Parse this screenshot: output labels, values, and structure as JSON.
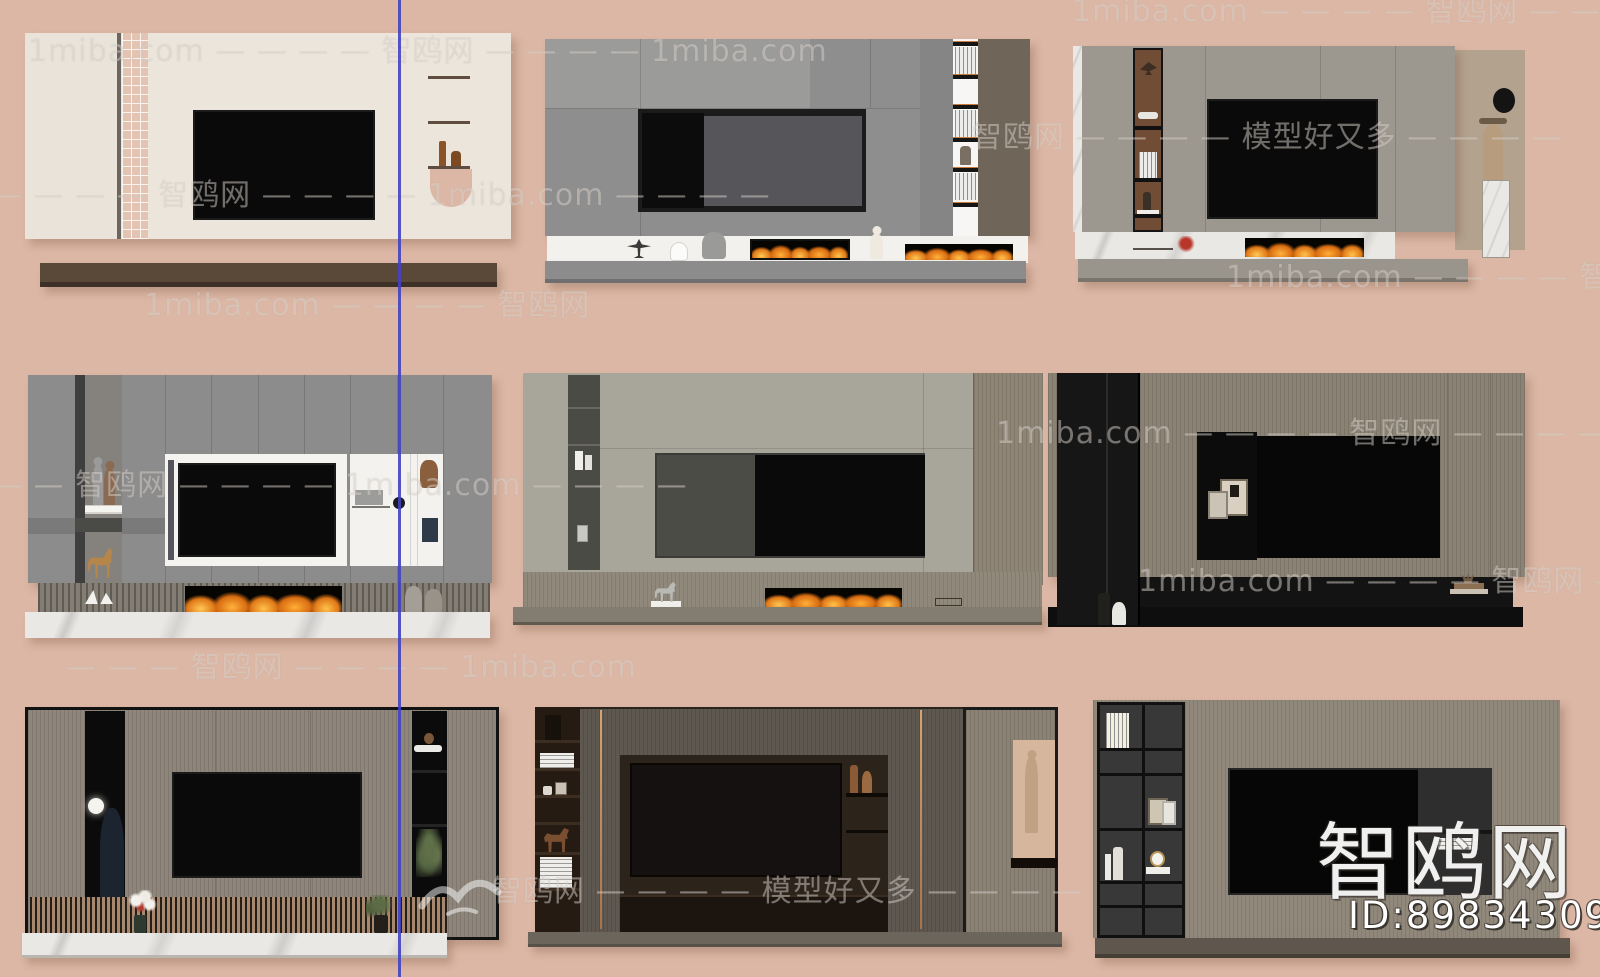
{
  "canvas": {
    "background_color": "#dcb7a5",
    "divider_line_color": "#4343c4",
    "accent_flame_color": "#e07818"
  },
  "watermark": {
    "brand_site": "1miba.com",
    "brand_name": "智鸥网",
    "brand_slogan": "模型好又多",
    "logo": {
      "text": "智鸥网",
      "id": "ID:898343095"
    },
    "rows": [
      {
        "text": "1miba.com — — — — 智鸥网 — — — — —"
      },
      {
        "text": "1miba.com — — — — 智鸥网 — — — — 1miba.com"
      },
      {
        "text": "智鸥网 — — — — 模型好又多 — — — —"
      },
      {
        "text": "— — — — 智鸥网 — — — — 1miba.com — — — —"
      },
      {
        "text": "1miba.com — — — — 智鸥网 —"
      },
      {
        "text": "1miba.com — — — — 智鸥网"
      },
      {
        "text": "1miba.com — — — — 智鸥网 — — — — 1miba.com — —"
      },
      {
        "text": "— — 智鸥网 — — — — 1miba.com — — — —"
      },
      {
        "text": "1miba.com — — — — 智鸥网 — — —"
      },
      {
        "text": "— — — 智鸥网 — — — — 1miba.com"
      },
      {
        "text": "智鸥网 — — — — 模型好又多 — — — —"
      }
    ]
  }
}
